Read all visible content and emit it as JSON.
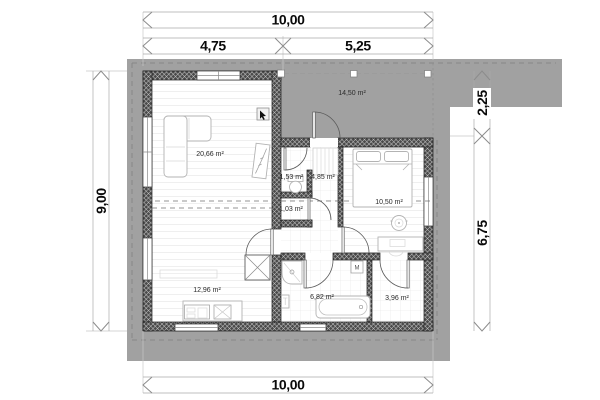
{
  "dimensions": {
    "top_total": "10,00",
    "top_left": "4,75",
    "top_right": "5,25",
    "left_total": "9,00",
    "right_upper": "2,25",
    "right_lower": "6,75",
    "bottom_total": "10,00"
  },
  "rooms": {
    "living": "20,66 m²",
    "kitchen": "12,96 m²",
    "terrace": "14,50 m²",
    "wc": "1,53 m²",
    "hall": "4,85 m²",
    "storage": "1,03 m²",
    "bedroom": "10,50 m²",
    "bathroom": "6,82 m²",
    "utility": "3,96 m²"
  },
  "symbols": {
    "washing_machine": "M"
  },
  "colors": {
    "ground": "#a1a1a1",
    "wall": "#4a4a4a",
    "dimension_text": "#0a0a0a"
  }
}
